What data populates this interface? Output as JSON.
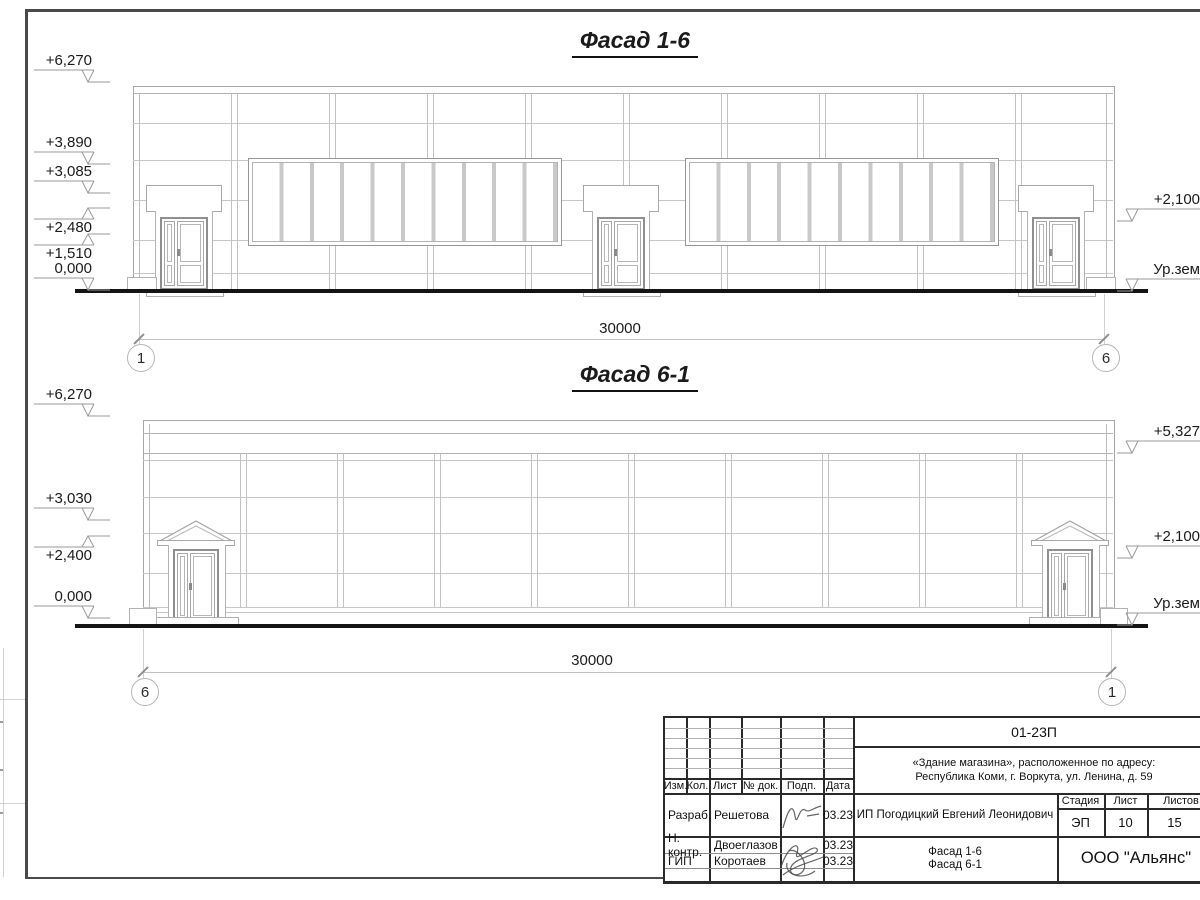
{
  "facade1": {
    "title": "Фасад 1-6",
    "left_marks": [
      "+6,270",
      "+3,890",
      "+3,085",
      "+2,480",
      "+1,510",
      "0,000"
    ],
    "right_marks": [
      "+2,100",
      "Ур.зем"
    ],
    "dimension": "30000",
    "axis_left": "1",
    "axis_right": "6"
  },
  "facade2": {
    "title": "Фасад 6-1",
    "left_marks": [
      "+6,270",
      "+3,030",
      "+2,400",
      "0,000"
    ],
    "right_marks": [
      "+5,327",
      "+2,100",
      "Ур.зем"
    ],
    "dimension": "30000",
    "axis_left": "6",
    "axis_right": "1"
  },
  "titleblock": {
    "doc_number": "01-23П",
    "project_line1": "«Здание магазина», расположенное по адресу:",
    "project_line2": "Республика Коми, г. Воркута, ул. Ленина, д. 59",
    "client": "ИП Погодицкий Евгений Леонидович",
    "headers": {
      "izm": "Изм.",
      "kol": "Кол.",
      "list": "Лист",
      "doc": "№ док.",
      "podp": "Подп.",
      "data": "Дата",
      "stage": "Стадия",
      "sheet": "Лист",
      "sheets": "Листов"
    },
    "rows": [
      {
        "role": "Разраб.",
        "name": "Решетова",
        "date": "03.23"
      },
      {
        "role": "Н. контр.",
        "name": "Двоеглазов",
        "date": "03.23"
      },
      {
        "role": "ГИП",
        "name": "Коротаев",
        "date": "03.23"
      }
    ],
    "stage_value": "ЭП",
    "sheet_value": "10",
    "sheets_value": "15",
    "drawing_line1": "Фасад 1-6",
    "drawing_line2": "Фасад 6-1",
    "company": "ООО \"Альянс\""
  }
}
